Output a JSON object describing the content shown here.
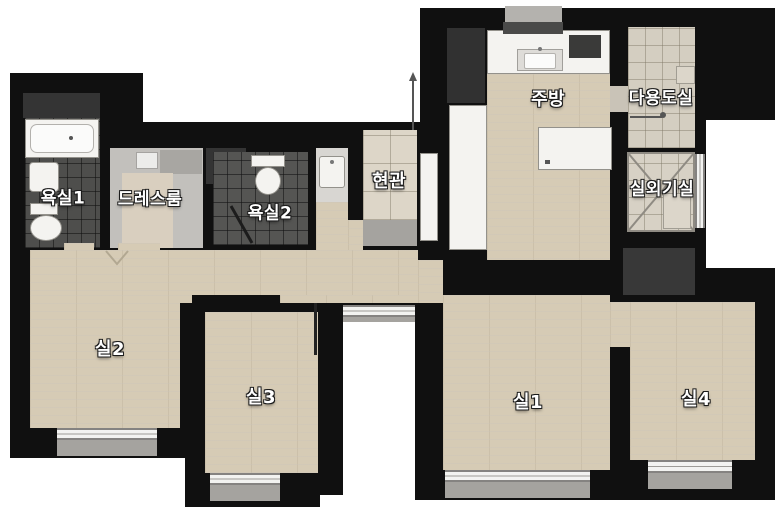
{
  "meta": {
    "type": "apartment-floor-plan",
    "language": "ko"
  },
  "rooms": [
    {
      "id": "bathroom-1",
      "label": "욕실1"
    },
    {
      "id": "dress-room",
      "label": "드레스룸"
    },
    {
      "id": "bathroom-2",
      "label": "욕실2"
    },
    {
      "id": "entrance",
      "label": "현관"
    },
    {
      "id": "kitchen",
      "label": "주방"
    },
    {
      "id": "utility-room",
      "label": "다용도실"
    },
    {
      "id": "outdoor-unit-room",
      "label": "실외기실"
    },
    {
      "id": "room-2",
      "label": "실2"
    },
    {
      "id": "room-3",
      "label": "실3"
    },
    {
      "id": "room-1",
      "label": "실1"
    },
    {
      "id": "room-4",
      "label": "실4"
    }
  ],
  "fixtures": [
    "bathtub",
    "washbasin",
    "toilet",
    "kitchen-sink",
    "stove",
    "range-hood",
    "refrigerator",
    "island-table",
    "tall-cabinet",
    "outdoor-unit-x",
    "door-swing",
    "utility-shaft"
  ],
  "colors": {
    "wall": "#101010",
    "wood_floor": "#d6cbb5",
    "bath_tile": "#4e4e4c",
    "entrance_tile": "#ddd6c8",
    "utility_tile": "#d4cec1",
    "fixture_white": "#f4f3f0",
    "window": "#f3f3f1",
    "window_sill": "#a5a39f",
    "dark_cabinet": "#343434",
    "label_text": "#ffffff"
  }
}
